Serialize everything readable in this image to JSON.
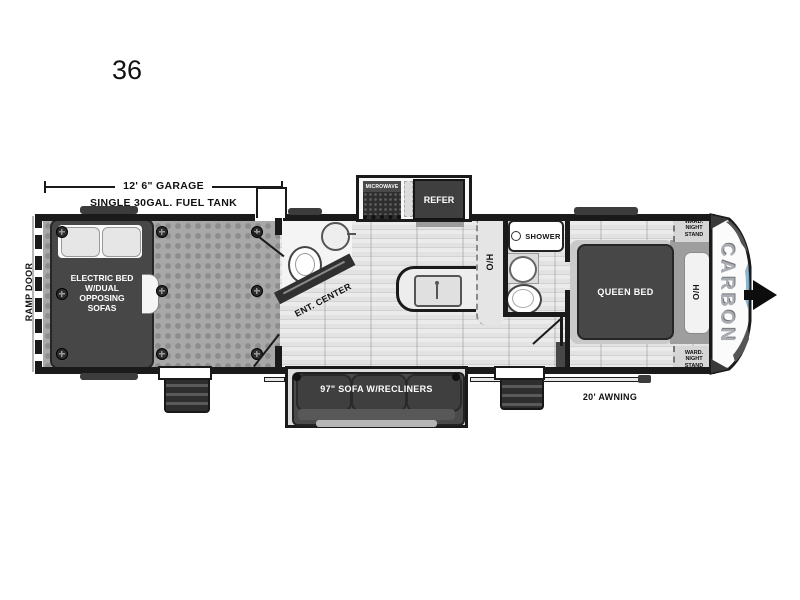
{
  "plan": {
    "model_number": "36",
    "brand_logo": "CARBON"
  },
  "dimensions": {
    "garage_length": "12' 6\" GARAGE",
    "fuel_tank": "SINGLE 30GAL. FUEL TANK",
    "awning_length": "20' AWNING"
  },
  "labels": {
    "ramp_door": "RAMP DOOR",
    "electric_bed_lines": [
      "ELECTRIC BED",
      "W/DUAL",
      "OPPOSING",
      "SOFAS"
    ],
    "ent_center": "ENT. CENTER",
    "microwave": "MICROWAVE",
    "refer": "REFER",
    "shower": "SHOWER",
    "overhead_kitchen": "O/H",
    "overhead_bedroom": "O/H",
    "queen_bed": "QUEEN BED",
    "ward_nightstand_lines": [
      "WARD.",
      "NIGHT",
      "STAND"
    ],
    "sofa": "97\" SOFA W/RECLINERS"
  },
  "colors": {
    "wall": "#1a1a1a",
    "garage_floor": "#a8a8a8",
    "main_floor": "#e4e4e4",
    "furniture_dark": "#474747",
    "accent_blue": "#7aa7c7"
  }
}
